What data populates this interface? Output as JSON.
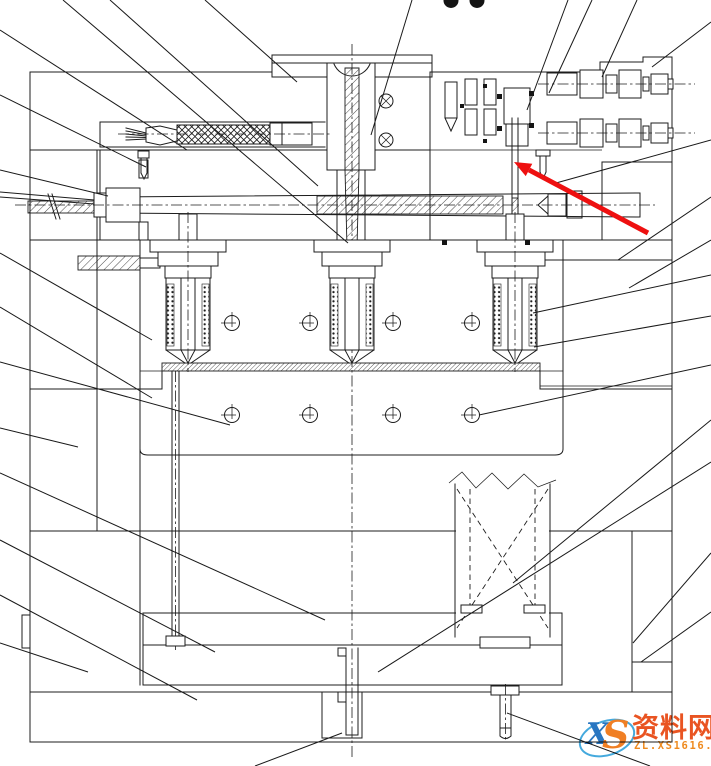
{
  "document": {
    "kind": "injection-mold sectional assembly drawing",
    "background": "#ffffff",
    "line_color": "#1c1c1c"
  },
  "watermark": {
    "logo_x": "X",
    "logo_s": "S",
    "brand": "资料网",
    "domain": "ZL.XS1616.COM",
    "ellipse_color": "#3aa4dc",
    "brand_color": "#e84b16",
    "domain_color": "#ee8412"
  },
  "drawing": {
    "center_axis_x": 352,
    "nozzle_centers_x": [
      188,
      352,
      515
    ],
    "screw_symbols": {
      "xs": [
        232,
        310,
        393,
        472
      ],
      "rows_y": [
        323,
        415
      ],
      "radius": 7.5
    },
    "ring_screws": [
      {
        "x": 386,
        "y": 101
      },
      {
        "x": 386,
        "y": 140
      }
    ],
    "cylinder_rows_y": [
      84,
      133
    ]
  },
  "annotations": {
    "red_arrow": {
      "tip": [
        514,
        162
      ],
      "tail": [
        648,
        233
      ],
      "color": "#ee1010",
      "width": 5
    },
    "top_dots": [
      {
        "x": 451,
        "y": 0.5,
        "r": 7.5
      },
      {
        "x": 477,
        "y": 0.5,
        "r": 7.5
      }
    ],
    "leader_lines": [
      [
        0,
        30,
        187,
        150
      ],
      [
        0,
        95,
        146,
        167
      ],
      [
        0,
        170,
        108,
        196
      ],
      [
        0,
        253,
        152,
        340
      ],
      [
        0,
        307,
        152,
        398
      ],
      [
        0,
        362,
        230,
        425
      ],
      [
        0,
        428,
        78,
        447
      ],
      [
        0,
        473,
        325,
        620
      ],
      [
        0,
        540,
        215,
        652
      ],
      [
        0,
        595,
        197,
        700
      ],
      [
        0,
        643,
        88,
        672
      ],
      [
        63,
        0,
        348,
        243
      ],
      [
        110,
        0,
        318,
        186
      ],
      [
        205,
        0,
        297,
        82
      ],
      [
        412,
        0,
        371,
        135
      ],
      [
        568,
        0,
        527,
        110
      ],
      [
        592,
        0,
        549,
        93
      ],
      [
        637,
        0,
        602,
        77
      ],
      [
        711,
        22,
        652,
        67
      ],
      [
        711,
        140,
        556,
        183
      ],
      [
        711,
        197,
        618,
        260
      ],
      [
        711,
        240,
        629,
        288
      ],
      [
        711,
        275,
        533,
        313
      ],
      [
        711,
        316,
        534,
        347
      ],
      [
        711,
        365,
        479,
        415
      ],
      [
        711,
        420,
        513,
        583
      ],
      [
        711,
        462,
        378,
        672
      ],
      [
        711,
        553,
        633,
        643
      ],
      [
        711,
        612,
        641,
        662
      ],
      [
        255,
        766,
        342,
        733
      ],
      [
        650,
        766,
        507,
        713
      ]
    ]
  }
}
